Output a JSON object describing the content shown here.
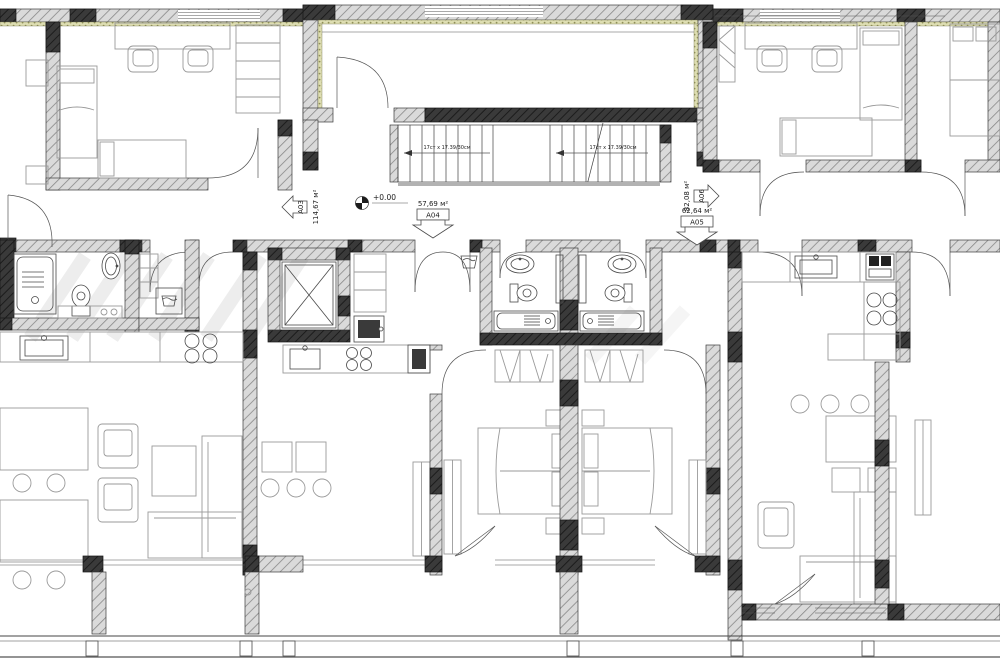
{
  "plan": {
    "type": "architectural-floor-plan",
    "elevation_marker": "+0.00",
    "apartments": [
      {
        "id": "A03",
        "area": "114,67 м²",
        "arrow_direction": "left"
      },
      {
        "id": "A04",
        "area": "57,69 м²",
        "arrow_direction": "down"
      },
      {
        "id": "A05",
        "area": "62,64 м²",
        "arrow_direction": "down"
      },
      {
        "id": "A06",
        "area": "82,08 м²",
        "arrow_direction": "right"
      }
    ],
    "stairs": {
      "note_flight_1": "17ст x 17.39/30см",
      "note_flight_2": "17ст x 17.39/30см"
    },
    "colors": {
      "background": "#ffffff",
      "wall_fill": "#d8d8d8",
      "wall_line": "#3c3c3c",
      "column_fill": "#2e2e2e",
      "insulation_fill": "#dcdcab",
      "furniture_line": "#9a9a9a",
      "fixture_line": "#4a4a4a"
    }
  }
}
